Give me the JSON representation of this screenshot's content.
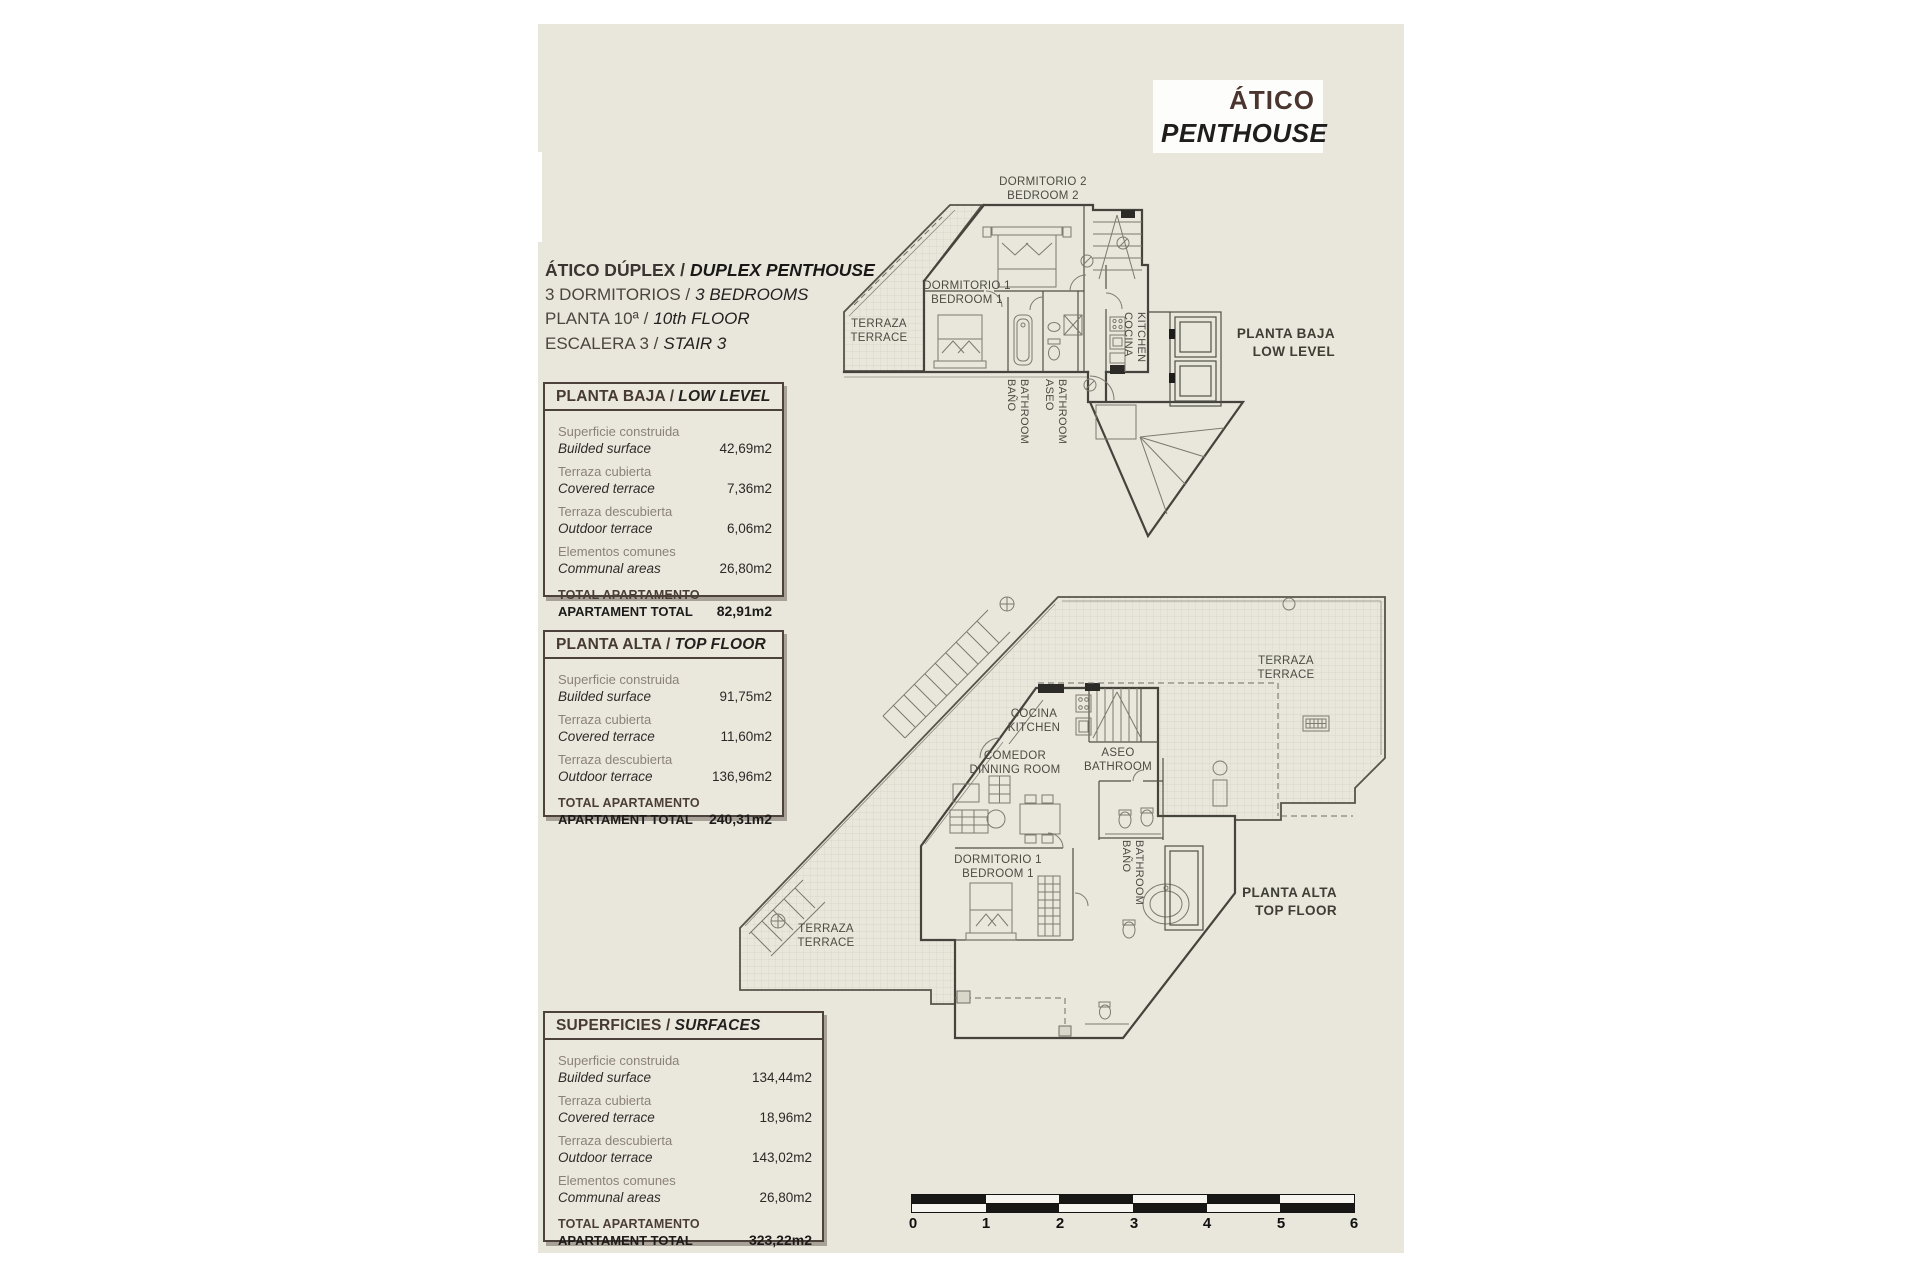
{
  "title_box": {
    "line1": "ÁTICO",
    "line2": "PENTHOUSE"
  },
  "info": {
    "line1_es": "ÁTICO DÚPLEX /",
    "line1_en": "DUPLEX PENTHOUSE",
    "line2_es": "3 DORMITORIOS /",
    "line2_en": "3 BEDROOMS",
    "line3_es": "PLANTA 10ª /",
    "line3_en": "10th FLOOR",
    "line4_es": "ESCALERA 3 /",
    "line4_en": "STAIR 3"
  },
  "boxes": {
    "low_level": {
      "title_es": "PLANTA BAJA /",
      "title_en": "LOW LEVEL",
      "rows": [
        {
          "es": "Superficie construida",
          "en": "Builded surface",
          "value": "42,69m2"
        },
        {
          "es": "Terraza cubierta",
          "en": "Covered terrace",
          "value": "7,36m2"
        },
        {
          "es": "Terraza descubierta",
          "en": "Outdoor terrace",
          "value": "6,06m2"
        },
        {
          "es": "Elementos comunes",
          "en": "Communal areas",
          "value": "26,80m2"
        }
      ],
      "total_es": "TOTAL APARTAMENTO",
      "total_en": "APARTAMENT TOTAL",
      "total_value": "82,91m2"
    },
    "top_floor": {
      "title_es": "PLANTA ALTA /",
      "title_en": "TOP FLOOR",
      "rows": [
        {
          "es": "Superficie construida",
          "en": "Builded surface",
          "value": "91,75m2"
        },
        {
          "es": "Terraza cubierta",
          "en": "Covered terrace",
          "value": "11,60m2"
        },
        {
          "es": "Terraza descubierta",
          "en": "Outdoor terrace",
          "value": "136,96m2"
        }
      ],
      "total_es": "TOTAL APARTAMENTO",
      "total_en": "APARTAMENT TOTAL",
      "total_value": "240,31m2"
    },
    "surfaces": {
      "title_es": "SUPERFICIES /",
      "title_en": "SURFACES",
      "rows": [
        {
          "es": "Superficie construida",
          "en": "Builded surface",
          "value": "134,44m2"
        },
        {
          "es": "Terraza cubierta",
          "en": "Covered terrace",
          "value": "18,96m2"
        },
        {
          "es": "Terraza descubierta",
          "en": "Outdoor terrace",
          "value": "143,02m2"
        },
        {
          "es": "Elementos comunes",
          "en": "Communal areas",
          "value": "26,80m2"
        }
      ],
      "total_es": "TOTAL APARTAMENTO",
      "total_en": "APARTAMENT TOTAL",
      "total_value": "323,22m2"
    }
  },
  "plan_low": {
    "dormitorio2_es": "DORMITORIO 2",
    "dormitorio2_en": "BEDROOM 2",
    "dormitorio1_es": "DORMITORIO 1",
    "dormitorio1_en": "BEDROOM 1",
    "terraza_es": "TERRAZA",
    "terraza_en": "TERRACE",
    "bano_es": "BAÑO",
    "bano_en": "BATHROOM",
    "aseo_es": "ASEO",
    "aseo_en": "BATHROOM",
    "cocina_es": "COCINA",
    "cocina_en": "KITCHEN",
    "caption_es": "PLANTA BAJA",
    "caption_en": "LOW LEVEL"
  },
  "plan_top": {
    "terraza1_es": "TERRAZA",
    "terraza1_en": "TERRACE",
    "cocina_es": "COCINA",
    "cocina_en": "KITCHEN",
    "comedor_es": "COMEDOR",
    "comedor_en": "DINNING ROOM",
    "aseo_es": "ASEO",
    "aseo_en": "BATHROOM",
    "dormitorio1_es": "DORMITORIO 1",
    "dormitorio1_en": "BEDROOM 1",
    "bano_es": "BAÑO",
    "bano_en": "BATHROOM",
    "terraza2_es": "TERRAZA",
    "terraza2_en": "TERRACE",
    "caption_es": "PLANTA ALTA",
    "caption_en": "TOP FLOOR"
  },
  "scale_bar": {
    "labels": [
      "0",
      "1",
      "2",
      "3",
      "4",
      "5",
      "6"
    ]
  },
  "colors": {
    "sheet_bg": "#e9e7dc",
    "canvas_bg": "#ffffff",
    "accent_brown": "#4a3b33",
    "text_dark": "#23211f",
    "text_gray": "#8b8178",
    "plan_line": "#44433c"
  }
}
